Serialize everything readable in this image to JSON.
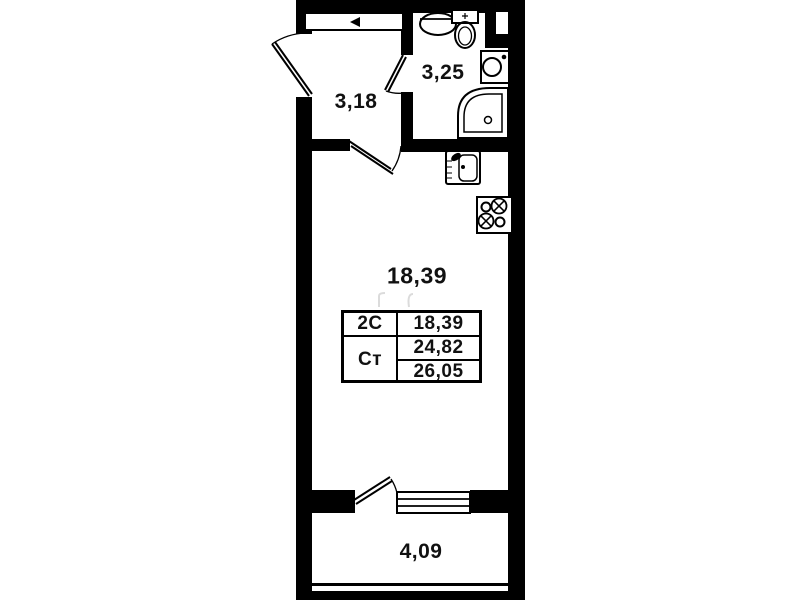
{
  "colors": {
    "wall": "#000000",
    "background": "#ffffff",
    "label": "#111111"
  },
  "rooms": {
    "hallway": {
      "label": "3,18"
    },
    "bathroom": {
      "label": "3,25"
    },
    "living_room": {
      "label": "18,39"
    },
    "balcony": {
      "label": "4,09"
    }
  },
  "legend_table": {
    "rows": [
      {
        "label": "2С",
        "value": "18,39"
      },
      {
        "label": "Ст",
        "values": [
          "24,82",
          "26,05"
        ]
      }
    ]
  },
  "fixtures": {
    "bathroom": [
      "washbasin-icon",
      "toilet-icon",
      "washing-machine-icon",
      "shower-tray-icon",
      "vent-shaft-icon"
    ],
    "kitchen": [
      "kitchen-sink-icon",
      "stove-burners-icon"
    ],
    "doors": [
      "entrance-door-icon",
      "bathroom-door-icon",
      "living-room-door-icon",
      "balcony-door-icon"
    ],
    "windows": [
      "balcony-window-icon"
    ],
    "storage": [
      "wardrobe-icon"
    ]
  }
}
